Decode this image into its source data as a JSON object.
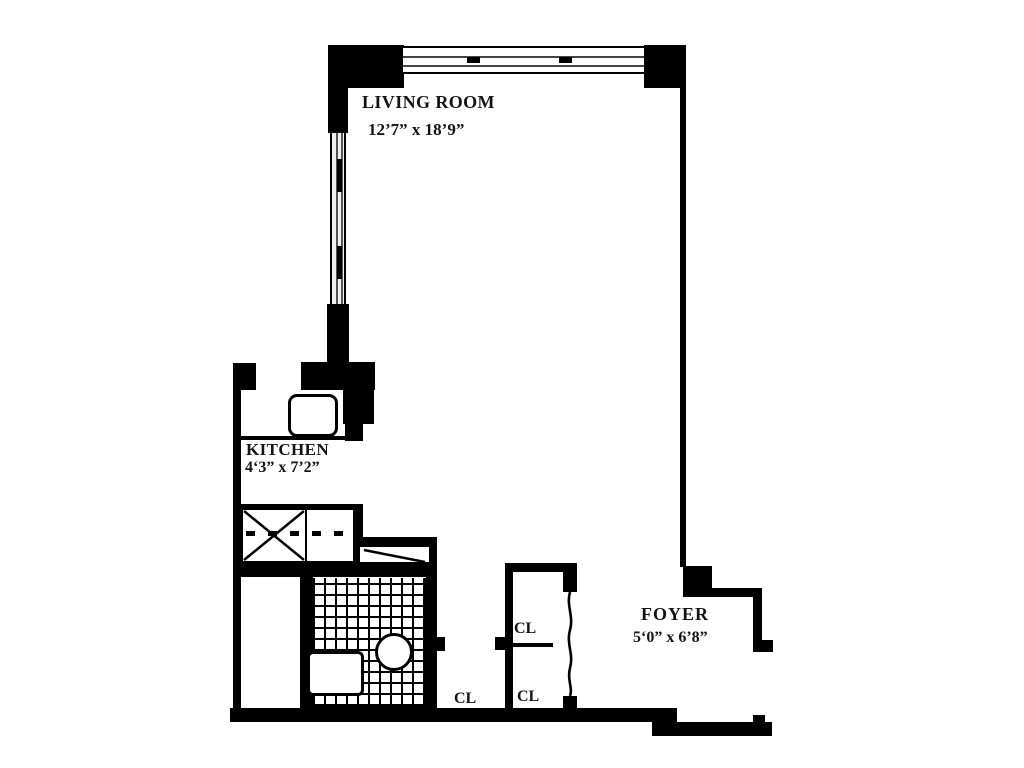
{
  "rooms": {
    "living_room": {
      "name": "LIVING ROOM",
      "dims": "12’7” x 18’9”"
    },
    "kitchen": {
      "name": "KITCHEN",
      "dims": "4‘3” x 7’2”"
    },
    "foyer": {
      "name": "FOYER",
      "dims": "5‘0” x 6’8”"
    }
  },
  "closets": {
    "upper_label": "CL",
    "lower_label": "CL",
    "hall_label": "CL"
  },
  "colors": {
    "wall": "#000000",
    "background": "#ffffff",
    "text": "#141414"
  }
}
